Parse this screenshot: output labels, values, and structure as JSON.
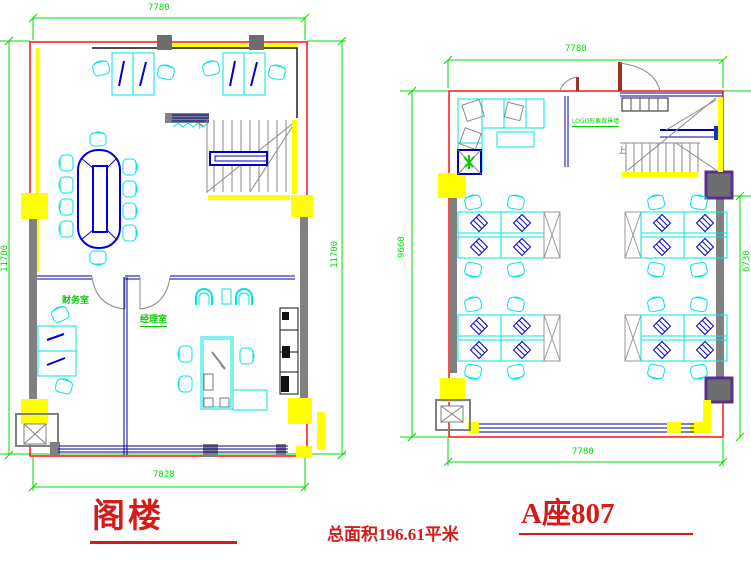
{
  "left_plan": {
    "title": "阁楼",
    "dim_top": "7780",
    "dim_left": "11700",
    "dim_right": "11700",
    "dim_bottom": "7828",
    "room_finance": "财务室",
    "room_manager": "经理室",
    "stair_marker": "下"
  },
  "right_plan": {
    "title": "A座807",
    "dim_top": "7780",
    "dim_left": "9660",
    "dim_right": "6730",
    "dim_bottom": "7780",
    "label_logo_wall": "LOGO形象背景墙",
    "stair_marker": "上"
  },
  "footer": {
    "total_area": "总面积196.61平米"
  },
  "colors": {
    "dimension_green": "#00dd00",
    "wall_red": "#ff0000",
    "furniture_cyan": "#00ffff",
    "furniture_blue": "#0000cc",
    "highlight_yellow": "#ffff00",
    "column_gray": "#6e6e6e",
    "column_purple": "#5b2d8e",
    "title_red": "#d51a1a"
  }
}
